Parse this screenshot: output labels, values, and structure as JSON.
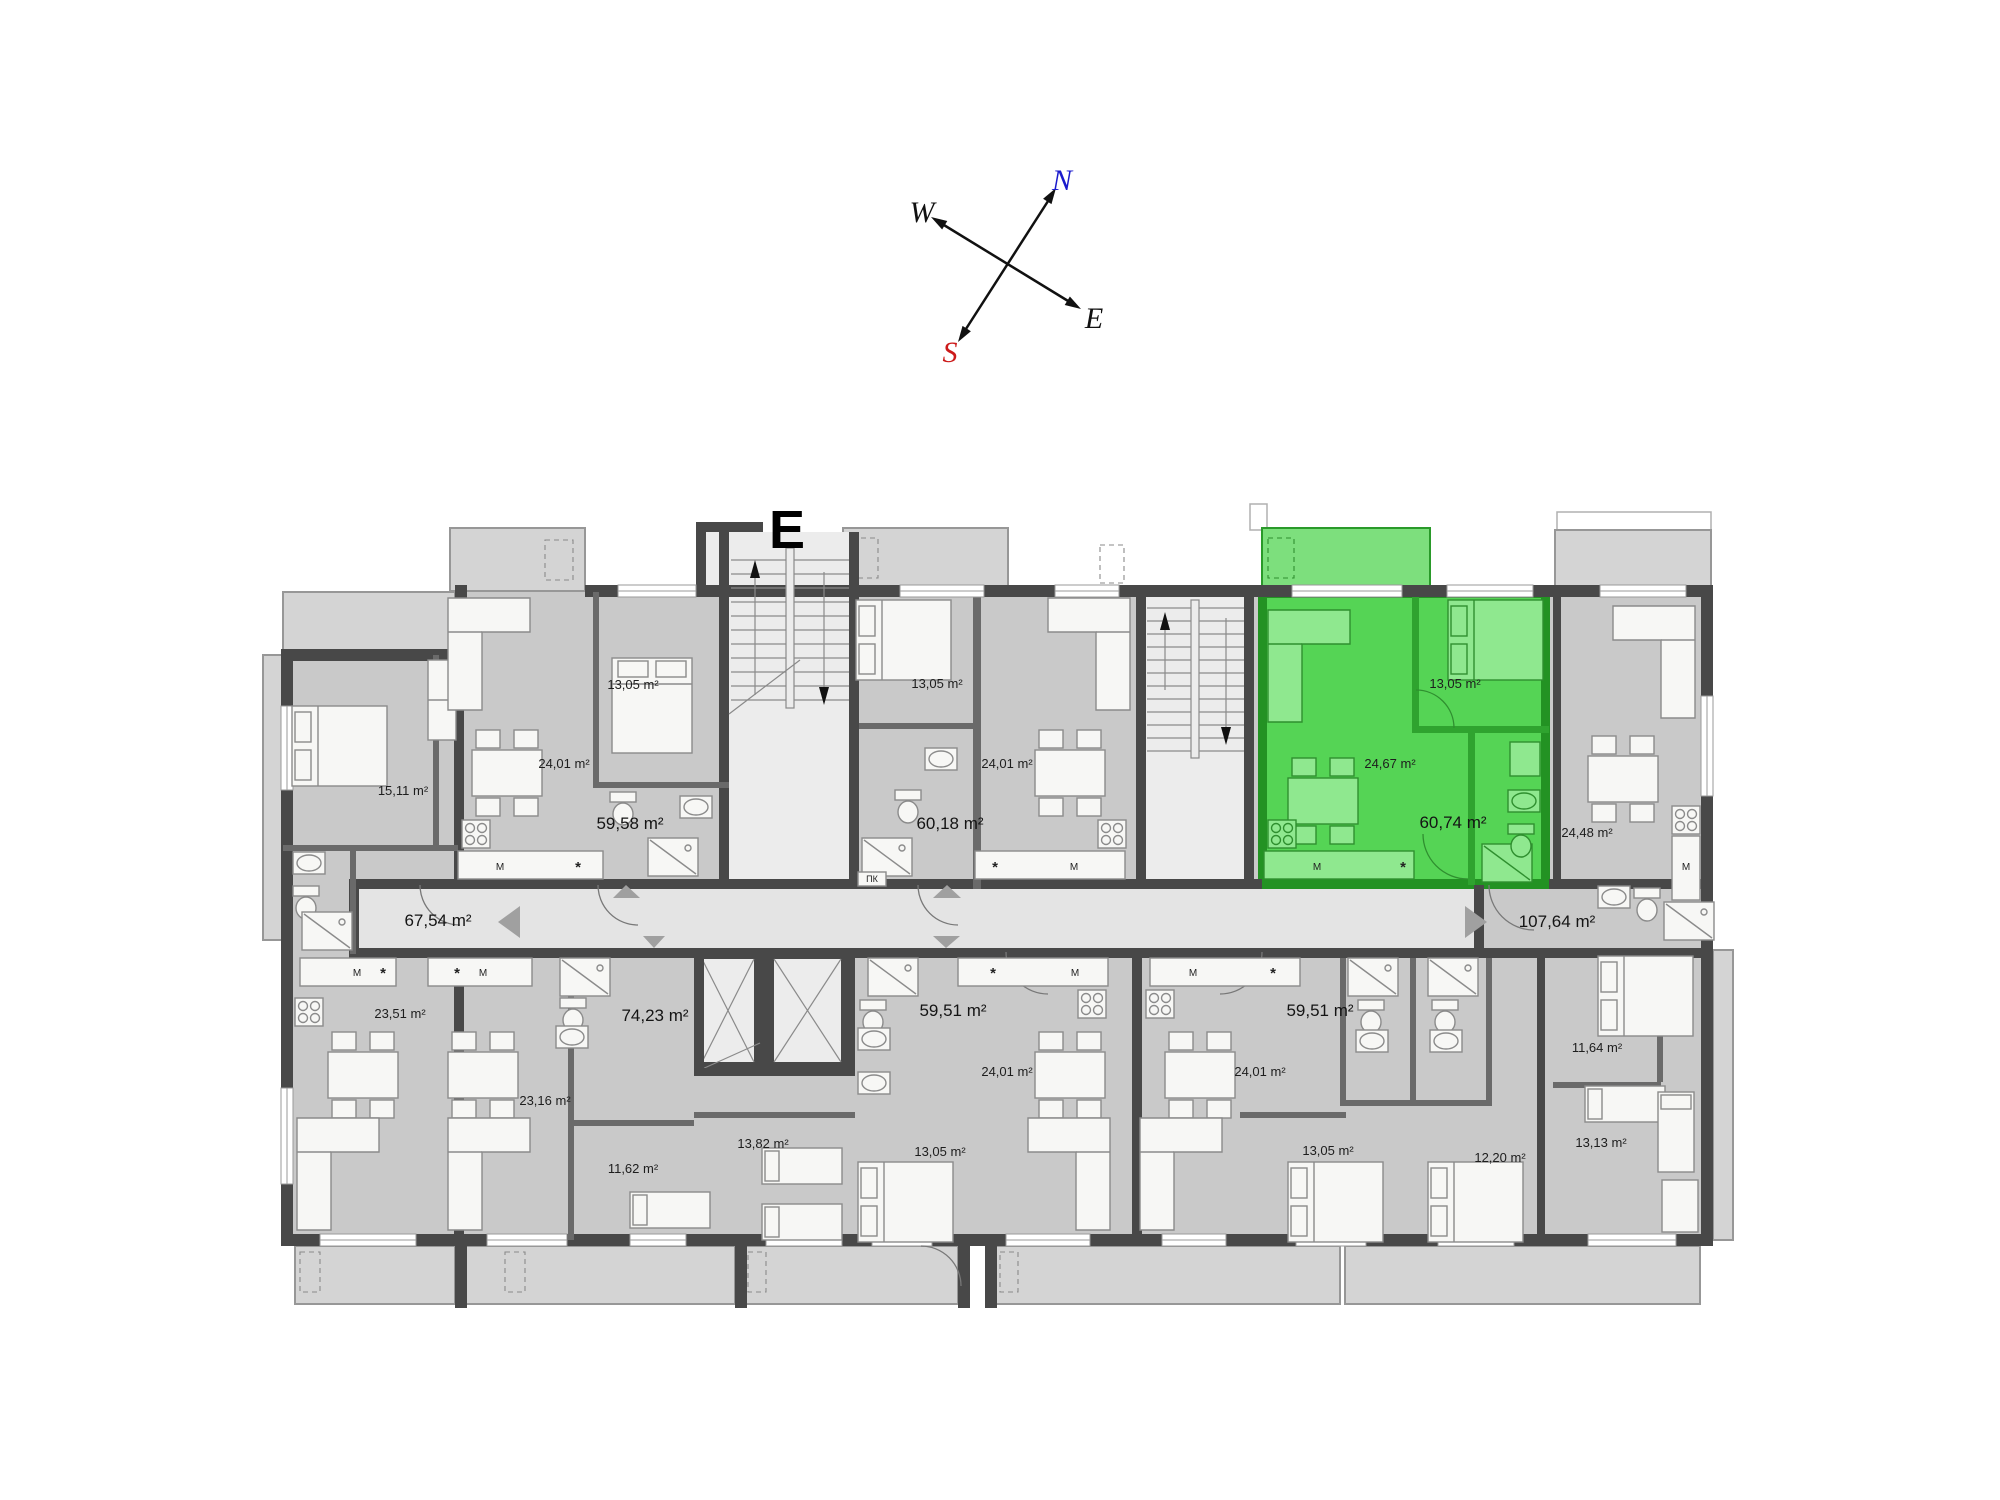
{
  "building_label": "E",
  "compass": {
    "north": "N",
    "west": "W",
    "east": "E",
    "south": "S",
    "north_color": "#1a1acc",
    "south_color": "#cc1a1a",
    "arrow_color": "#111111"
  },
  "fixtures": {
    "washing_machine": "M",
    "dishwasher": "*",
    "pk": "ПК"
  },
  "colors": {
    "floor": "#c9c9c9",
    "corridor": "#e4e4e4",
    "wall": "#484848",
    "highlight_fill": "#55d455",
    "highlight_wall": "#239223",
    "terrace": "#d4d4d4",
    "label": "#1d1d1d"
  },
  "rooms": [
    {
      "name": "bedroom-15-11",
      "area": "15,11 m²"
    },
    {
      "name": "living-24-01-a",
      "area": "24,01 m²"
    },
    {
      "name": "bedroom-13-05-a",
      "area": "13,05 m²"
    },
    {
      "name": "unit-59-58",
      "area": "59,58 m²"
    },
    {
      "name": "bedroom-13-05-b",
      "area": "13,05 m²"
    },
    {
      "name": "living-24-01-b",
      "area": "24,01 m²"
    },
    {
      "name": "unit-60-18",
      "area": "60,18 m²"
    },
    {
      "name": "living-24-67-green",
      "area": "24,67 m²"
    },
    {
      "name": "bedroom-13-05-c-green",
      "area": "13,05 m²"
    },
    {
      "name": "unit-60-74-green",
      "area": "60,74 m²"
    },
    {
      "name": "living-24-48",
      "area": "24,48 m²"
    },
    {
      "name": "unit-107-64",
      "area": "107,64 m²"
    },
    {
      "name": "unit-67-54",
      "area": "67,54 m²"
    },
    {
      "name": "living-23-51",
      "area": "23,51 m²"
    },
    {
      "name": "unit-74-23",
      "area": "74,23 m²"
    },
    {
      "name": "unit-59-51-a",
      "area": "59,51 m²"
    },
    {
      "name": "living-24-01-c",
      "area": "24,01 m²"
    },
    {
      "name": "living-23-16",
      "area": "23,16 m²"
    },
    {
      "name": "bedroom-11-62",
      "area": "11,62 m²"
    },
    {
      "name": "bedroom-13-82",
      "area": "13,82 m²"
    },
    {
      "name": "bedroom-13-05-d",
      "area": "13,05 m²"
    },
    {
      "name": "unit-59-51-b",
      "area": "59,51 m²"
    },
    {
      "name": "living-24-01-d",
      "area": "24,01 m²"
    },
    {
      "name": "bedroom-13-05-e",
      "area": "13,05 m²"
    },
    {
      "name": "bedroom-12-20",
      "area": "12,20 m²"
    },
    {
      "name": "bedroom-11-64",
      "area": "11,64 m²"
    },
    {
      "name": "bedroom-13-13",
      "area": "13,13 m²"
    }
  ]
}
